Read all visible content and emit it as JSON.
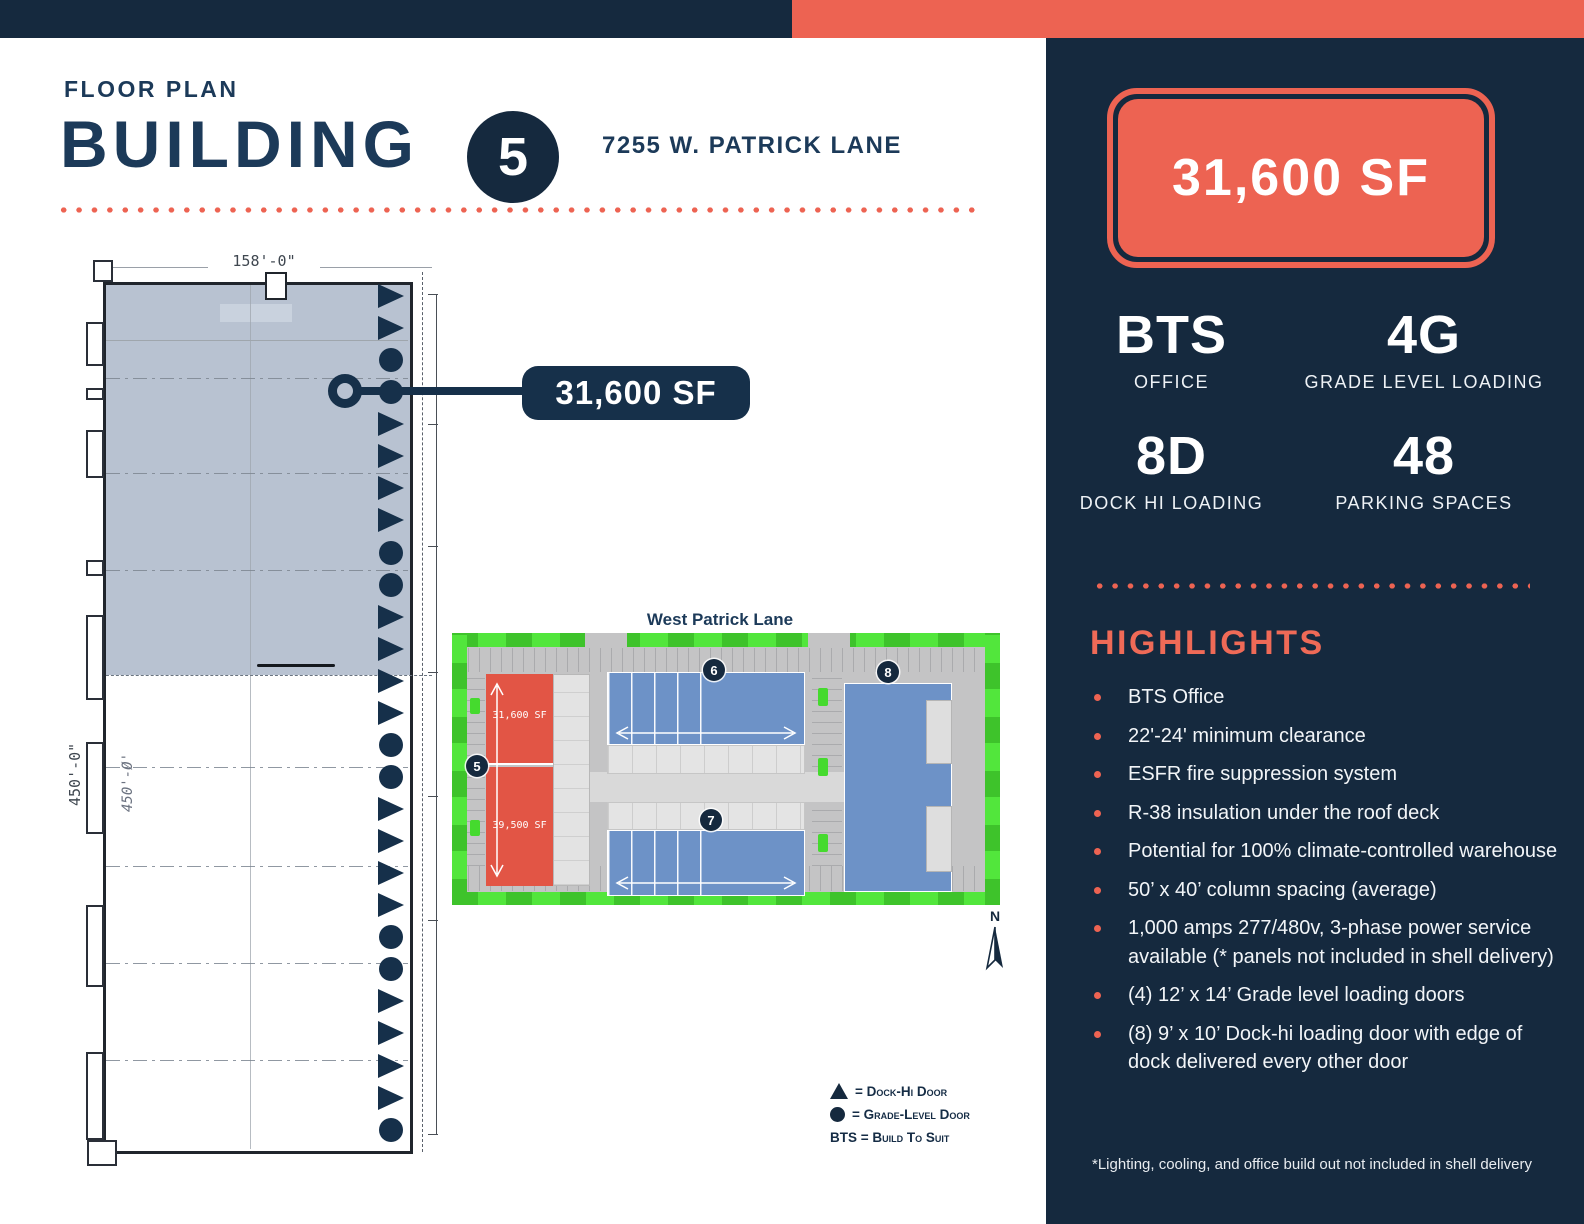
{
  "header": {
    "eyebrow": "FLOOR PLAN",
    "title": "BUILDING",
    "building_number": "5",
    "address": "7255 W. PATRICK LANE"
  },
  "floor_plan": {
    "width_dim": "158'-0\"",
    "height_dim": "450'-0\"",
    "height_dim_alt": "450'-Ø'",
    "callout_label": "31,600 SF",
    "doors": [
      "dock",
      "dock",
      "grade",
      "grade",
      "dock",
      "dock",
      "dock",
      "dock",
      "grade",
      "grade",
      "dock",
      "dock",
      "dock",
      "dock",
      "grade",
      "grade",
      "dock",
      "dock",
      "dock",
      "dock",
      "grade",
      "grade",
      "dock",
      "dock",
      "dock",
      "dock",
      "grade"
    ]
  },
  "site_plan": {
    "street": "West Patrick Lane",
    "north_label": "N",
    "buildings": [
      {
        "number": "5",
        "labels": [
          "31,600 SF",
          "39,500 SF"
        ]
      },
      {
        "number": "6"
      },
      {
        "number": "7"
      },
      {
        "number": "8"
      }
    ]
  },
  "legend": {
    "dock": "= Dock-Hi Door",
    "grade": "= Grade-Level Door",
    "bts": "BTS = Build To Suit"
  },
  "sidebar": {
    "sf_badge": "31,600 SF",
    "stats": [
      {
        "value": "BTS",
        "label": "OFFICE"
      },
      {
        "value": "4G",
        "label": "GRADE LEVEL LOADING"
      },
      {
        "value": "8D",
        "label": "DOCK HI LOADING"
      },
      {
        "value": "48",
        "label": "PARKING SPACES"
      }
    ],
    "highlights_title": "HIGHLIGHTS",
    "highlights": [
      "BTS Office",
      "22'-24' minimum clearance",
      "ESFR fire suppression system",
      "R-38 insulation under the roof deck",
      "Potential for 100% climate-controlled warehouse",
      "50’ x 40’ column spacing (average)",
      "1,000 amps 277/480v, 3-phase power service available (* panels not included in shell delivery)",
      "(4) 12’ x 14’ Grade level loading doors",
      "(8) 9’ x 10’ Dock-hi loading door with edge of dock delivered every other door"
    ],
    "footnote": "*Lighting, cooling, and office build out not included in shell delivery"
  },
  "colors": {
    "navy": "#15293e",
    "coral": "#ed6352",
    "plan_shade": "#b8c2d1",
    "site_blue": "#6d92c7",
    "site_red": "#e25545",
    "site_green": "#45da2e"
  }
}
